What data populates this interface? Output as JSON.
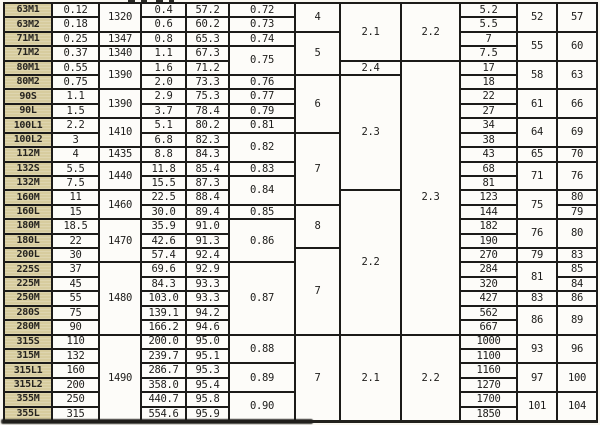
{
  "colors": {
    "paper": "#faf8f2",
    "line": "#1c1b19",
    "cell_bg": "#fdfcf9",
    "model_cell_bg": "#d7cc9e",
    "ink": "#1e1d1b"
  },
  "table": {
    "row_count": 29,
    "columns": [
      {
        "name": "model",
        "width": 46,
        "shaded": true,
        "cells": [
          {
            "t": "63M1"
          },
          {
            "t": "63M2"
          },
          {
            "t": "71M1"
          },
          {
            "t": "71M2"
          },
          {
            "t": "80M1"
          },
          {
            "t": "80M2"
          },
          {
            "t": "90S"
          },
          {
            "t": "90L"
          },
          {
            "t": "100L1"
          },
          {
            "t": "100L2"
          },
          {
            "t": "112M"
          },
          {
            "t": "132S"
          },
          {
            "t": "132M"
          },
          {
            "t": "160M"
          },
          {
            "t": "160L"
          },
          {
            "t": "180M"
          },
          {
            "t": "180L"
          },
          {
            "t": "200L"
          },
          {
            "t": "225S"
          },
          {
            "t": "225M"
          },
          {
            "t": "250M"
          },
          {
            "t": "280S"
          },
          {
            "t": "280M"
          },
          {
            "t": "315S"
          },
          {
            "t": "315M"
          },
          {
            "t": "315L1"
          },
          {
            "t": "315L2"
          },
          {
            "t": "355M"
          },
          {
            "t": "355L"
          }
        ]
      },
      {
        "name": "power-kw",
        "width": 45,
        "shaded": false,
        "cells": [
          {
            "t": "0.12"
          },
          {
            "t": "0.18"
          },
          {
            "t": "0.25"
          },
          {
            "t": "0.37"
          },
          {
            "t": "0.55"
          },
          {
            "t": "0.75"
          },
          {
            "t": "1.1"
          },
          {
            "t": "1.5"
          },
          {
            "t": "2.2"
          },
          {
            "t": "3"
          },
          {
            "t": "4"
          },
          {
            "t": "5.5"
          },
          {
            "t": "7.5"
          },
          {
            "t": "11"
          },
          {
            "t": "15"
          },
          {
            "t": "18.5"
          },
          {
            "t": "22"
          },
          {
            "t": "30"
          },
          {
            "t": "37"
          },
          {
            "t": "45"
          },
          {
            "t": "55"
          },
          {
            "t": "75"
          },
          {
            "t": "90"
          },
          {
            "t": "110"
          },
          {
            "t": "132"
          },
          {
            "t": "160"
          },
          {
            "t": "200"
          },
          {
            "t": "250"
          },
          {
            "t": "315"
          }
        ]
      },
      {
        "name": "speed-rpm",
        "width": 40,
        "shaded": false,
        "cells": [
          {
            "t": "1320",
            "s": 2
          },
          {
            "t": "1347"
          },
          {
            "t": "1340"
          },
          {
            "t": "1390",
            "s": 2
          },
          {
            "t": "1390",
            "s": 2
          },
          {
            "t": "1410",
            "s": 2
          },
          {
            "t": "1435"
          },
          {
            "t": "1440",
            "s": 2
          },
          {
            "t": "1460",
            "s": 2
          },
          {
            "t": "1470",
            "s": 3
          },
          {
            "t": "1480",
            "s": 5
          },
          {
            "t": "1490",
            "s": 6
          }
        ]
      },
      {
        "name": "current-a",
        "width": 43,
        "shaded": false,
        "cells": [
          {
            "t": "0.4"
          },
          {
            "t": "0.6"
          },
          {
            "t": "0.8"
          },
          {
            "t": "1.1"
          },
          {
            "t": "1.6"
          },
          {
            "t": "2.0"
          },
          {
            "t": "2.9"
          },
          {
            "t": "3.7"
          },
          {
            "t": "5.1"
          },
          {
            "t": "6.8"
          },
          {
            "t": "8.8"
          },
          {
            "t": "11.8"
          },
          {
            "t": "15.5"
          },
          {
            "t": "22.5"
          },
          {
            "t": "30.0"
          },
          {
            "t": "35.9"
          },
          {
            "t": "42.6"
          },
          {
            "t": "57.4"
          },
          {
            "t": "69.6"
          },
          {
            "t": "84.3"
          },
          {
            "t": "103.0"
          },
          {
            "t": "139.1"
          },
          {
            "t": "166.2"
          },
          {
            "t": "200.0"
          },
          {
            "t": "239.7"
          },
          {
            "t": "286.7"
          },
          {
            "t": "358.0"
          },
          {
            "t": "440.7"
          },
          {
            "t": "554.6"
          }
        ]
      },
      {
        "name": "efficiency-pct",
        "width": 41,
        "shaded": false,
        "cells": [
          {
            "t": "57.2"
          },
          {
            "t": "60.2"
          },
          {
            "t": "65.3"
          },
          {
            "t": "67.3"
          },
          {
            "t": "71.2"
          },
          {
            "t": "73.3"
          },
          {
            "t": "75.3"
          },
          {
            "t": "78.4"
          },
          {
            "t": "80.2"
          },
          {
            "t": "82.3"
          },
          {
            "t": "84.3"
          },
          {
            "t": "85.4"
          },
          {
            "t": "87.3"
          },
          {
            "t": "88.4"
          },
          {
            "t": "89.4"
          },
          {
            "t": "91.0"
          },
          {
            "t": "91.3"
          },
          {
            "t": "92.4"
          },
          {
            "t": "92.9"
          },
          {
            "t": "93.3"
          },
          {
            "t": "93.3"
          },
          {
            "t": "94.2"
          },
          {
            "t": "94.6"
          },
          {
            "t": "95.0"
          },
          {
            "t": "95.1"
          },
          {
            "t": "95.3"
          },
          {
            "t": "95.4"
          },
          {
            "t": "95.8"
          },
          {
            "t": "95.9"
          }
        ]
      },
      {
        "name": "power-factor",
        "width": 64,
        "shaded": false,
        "cells": [
          {
            "t": "0.72"
          },
          {
            "t": "0.73"
          },
          {
            "t": "0.74"
          },
          {
            "t": "0.75",
            "s": 2
          },
          {
            "t": "0.76"
          },
          {
            "t": "0.77"
          },
          {
            "t": "0.79"
          },
          {
            "t": "0.81"
          },
          {
            "t": "0.82",
            "s": 2
          },
          {
            "t": "0.83"
          },
          {
            "t": "0.84",
            "s": 2
          },
          {
            "t": "0.85"
          },
          {
            "t": "0.86",
            "s": 3
          },
          {
            "t": "0.87",
            "s": 5
          },
          {
            "t": "0.88",
            "s": 2
          },
          {
            "t": "0.89",
            "s": 2
          },
          {
            "t": "0.90",
            "s": 2
          }
        ]
      },
      {
        "name": "ratio-col7",
        "width": 43,
        "shaded": false,
        "cells": [
          {
            "t": "4",
            "s": 2
          },
          {
            "t": "5",
            "s": 3
          },
          {
            "t": "6",
            "s": 4
          },
          {
            "t": "7",
            "s": 5
          },
          {
            "t": "8",
            "s": 3
          },
          {
            "t": "7",
            "s": 6
          },
          {
            "t": "7",
            "s": 6
          }
        ]
      },
      {
        "name": "ratio-col8",
        "width": 59,
        "shaded": false,
        "cells": [
          {
            "t": "2.1",
            "s": 4
          },
          {
            "t": "2.4",
            "s": 1
          },
          {
            "t": "2.3",
            "s": 8
          },
          {
            "t": "2.2",
            "s": 10
          },
          {
            "t": "2.1",
            "s": 6
          }
        ]
      },
      {
        "name": "ratio-col9",
        "width": 57,
        "shaded": false,
        "cells": [
          {
            "t": "2.2",
            "s": 4
          },
          {
            "t": "2.3",
            "s": 19
          },
          {
            "t": "2.2",
            "s": 6
          }
        ]
      },
      {
        "name": "value-col10",
        "width": 55,
        "shaded": false,
        "cells": [
          {
            "t": "5.2"
          },
          {
            "t": "5.5"
          },
          {
            "t": "7"
          },
          {
            "t": "7.5"
          },
          {
            "t": "17"
          },
          {
            "t": "18"
          },
          {
            "t": "22"
          },
          {
            "t": "27"
          },
          {
            "t": "34"
          },
          {
            "t": "38"
          },
          {
            "t": "43"
          },
          {
            "t": "68"
          },
          {
            "t": "81"
          },
          {
            "t": "123"
          },
          {
            "t": "144"
          },
          {
            "t": "182"
          },
          {
            "t": "190"
          },
          {
            "t": "270"
          },
          {
            "t": "284"
          },
          {
            "t": "320"
          },
          {
            "t": "427"
          },
          {
            "t": "562"
          },
          {
            "t": "667"
          },
          {
            "t": "1000"
          },
          {
            "t": "1100"
          },
          {
            "t": "1160"
          },
          {
            "t": "1270"
          },
          {
            "t": "1700"
          },
          {
            "t": "1850"
          }
        ]
      },
      {
        "name": "value-col11",
        "width": 38,
        "shaded": false,
        "cells": [
          {
            "t": "52",
            "s": 2
          },
          {
            "t": "55",
            "s": 2
          },
          {
            "t": "58",
            "s": 2
          },
          {
            "t": "61",
            "s": 2
          },
          {
            "t": "64",
            "s": 2
          },
          {
            "t": "65"
          },
          {
            "t": "71",
            "s": 2
          },
          {
            "t": "75",
            "s": 2
          },
          {
            "t": "76",
            "s": 2
          },
          {
            "t": "79"
          },
          {
            "t": "81",
            "s": 2
          },
          {
            "t": "83"
          },
          {
            "t": "86",
            "s": 2
          },
          {
            "t": "93",
            "s": 2
          },
          {
            "t": "97",
            "s": 2
          },
          {
            "t": "101",
            "s": 2
          }
        ]
      },
      {
        "name": "value-col12",
        "width": 38,
        "shaded": false,
        "cells": [
          {
            "t": "57",
            "s": 2
          },
          {
            "t": "60",
            "s": 2
          },
          {
            "t": "63",
            "s": 2
          },
          {
            "t": "66",
            "s": 2
          },
          {
            "t": "69",
            "s": 2
          },
          {
            "t": "70"
          },
          {
            "t": "76",
            "s": 2
          },
          {
            "t": "80"
          },
          {
            "t": "79"
          },
          {
            "t": "80",
            "s": 2
          },
          {
            "t": "83"
          },
          {
            "t": "85"
          },
          {
            "t": "84"
          },
          {
            "t": "86"
          },
          {
            "t": "89",
            "s": 2
          },
          {
            "t": "96",
            "s": 2
          },
          {
            "t": "100",
            "s": 2
          },
          {
            "t": "104",
            "s": 2
          }
        ]
      }
    ]
  }
}
